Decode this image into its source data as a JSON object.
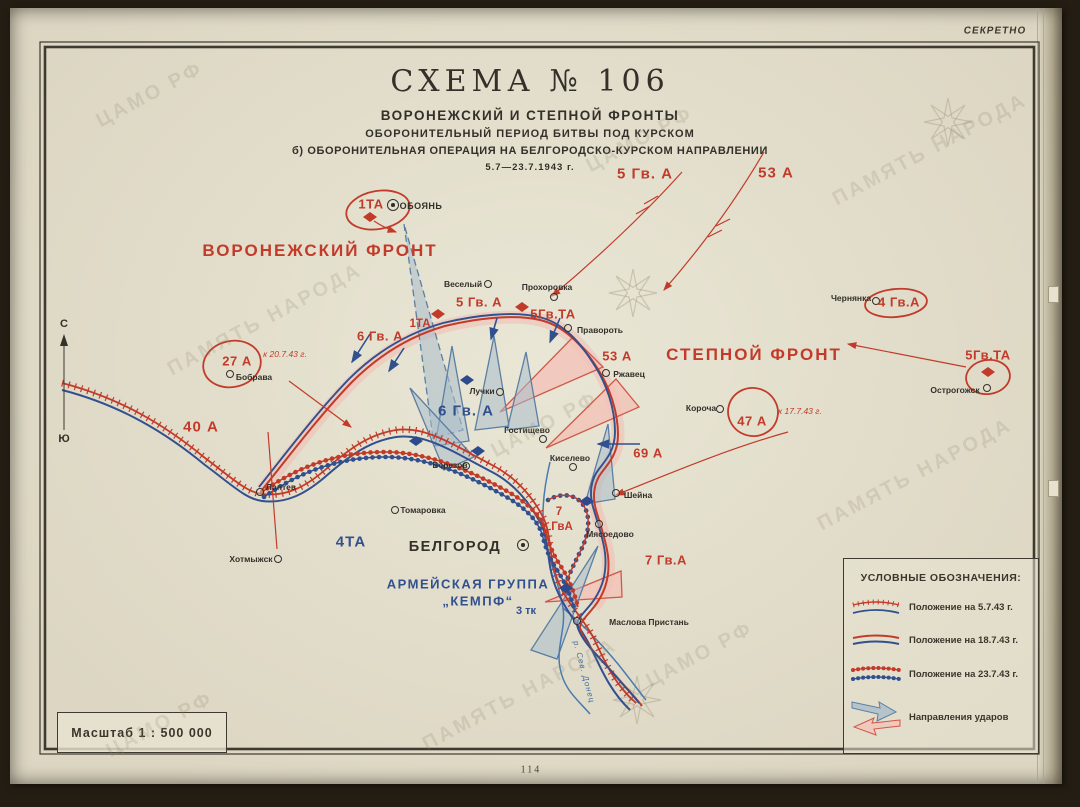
{
  "stamp": "СЕКРЕТНО",
  "title": {
    "main": "СХЕМА № 106",
    "sub1": "ВОРОНЕЖСКИЙ И СТЕПНОЙ ФРОНТЫ",
    "sub2": "ОБОРОНИТЕЛЬНЫЙ ПЕРИОД БИТВЫ ПОД КУРСКОМ",
    "sub3": "б) ОБОРОНИТЕЛЬНАЯ ОПЕРАЦИЯ НА БЕЛГОРОДСКО-КУРСКОМ НАПРАВЛЕНИИ",
    "dates": "5.7—23.7.1943 г."
  },
  "compass": {
    "north": "С",
    "south": "Ю"
  },
  "scale_label": "Масштаб 1 : 500 000",
  "page_number": "114",
  "legend": {
    "title": "УСЛОВНЫЕ ОБОЗНАЧЕНИЯ:",
    "items": [
      {
        "symbol": "position-5-7-43",
        "label": "Положение на  5.7.43 г."
      },
      {
        "symbol": "position-18-7-43",
        "label": "Положение на 18.7.43 г."
      },
      {
        "symbol": "position-23-7-43",
        "label": "Положение на 23.7.43 г."
      },
      {
        "symbol": "attack-directions",
        "label": "Направления ударов"
      }
    ]
  },
  "map_labels": [
    {
      "text": "ВОРОНЕЖСКИЙ ФРОНТ",
      "x": 320,
      "y": 251,
      "cls": "front"
    },
    {
      "text": "СТЕПНОЙ ФРОНТ",
      "x": 754,
      "y": 355,
      "cls": "front"
    },
    {
      "text": "5 Гв. А",
      "x": 645,
      "y": 174,
      "cls": "army-red-lg"
    },
    {
      "text": "53 А",
      "x": 776,
      "y": 173,
      "cls": "army-red-lg"
    },
    {
      "text": "1ТА",
      "x": 371,
      "y": 204,
      "cls": "army-red"
    },
    {
      "text": "5 Гв. А",
      "x": 479,
      "y": 302,
      "cls": "army-red"
    },
    {
      "text": "5Гв.ТА",
      "x": 553,
      "y": 314,
      "cls": "army-red"
    },
    {
      "text": "6 Гв. А",
      "x": 380,
      "y": 336,
      "cls": "army-red"
    },
    {
      "text": "1ТА",
      "x": 420,
      "y": 324,
      "cls": "army-red-sm"
    },
    {
      "text": "53 А",
      "x": 617,
      "y": 356,
      "cls": "army-red"
    },
    {
      "text": "69 А",
      "x": 648,
      "y": 453,
      "cls": "army-red"
    },
    {
      "text": "40 А",
      "x": 201,
      "y": 427,
      "cls": "army-red-lg"
    },
    {
      "text": "27 А",
      "x": 237,
      "y": 361,
      "cls": "army-red"
    },
    {
      "text": "к 20.7.43 г.",
      "x": 285,
      "y": 354,
      "cls": "note"
    },
    {
      "text": "47 А",
      "x": 752,
      "y": 421,
      "cls": "army-red"
    },
    {
      "text": "к 17.7.43 г.",
      "x": 800,
      "y": 411,
      "cls": "note"
    },
    {
      "text": "4 Гв.А",
      "x": 899,
      "y": 302,
      "cls": "army-red"
    },
    {
      "text": "5Гв.ТА",
      "x": 988,
      "y": 355,
      "cls": "army-red"
    },
    {
      "text": "7 Гв.А",
      "x": 666,
      "y": 560,
      "cls": "army-red"
    },
    {
      "text": "7",
      "x": 559,
      "y": 512,
      "cls": "army-red-sm"
    },
    {
      "text": "ГвА",
      "x": 562,
      "y": 527,
      "cls": "army-red-sm"
    },
    {
      "text": "4ТА",
      "x": 351,
      "y": 542,
      "cls": "army-blue"
    },
    {
      "text": "6 Гв. А",
      "x": 466,
      "y": 411,
      "cls": "army-blue"
    },
    {
      "text": "АРМЕЙСКАЯ ГРУППА",
      "x": 468,
      "y": 584,
      "cls": "army-blue-md"
    },
    {
      "text": "„КЕМПФ“",
      "x": 478,
      "y": 601,
      "cls": "army-blue-md"
    },
    {
      "text": "3 тк",
      "x": 526,
      "y": 611,
      "cls": "army-blue-sm"
    },
    {
      "text": "р. Сев. Донец",
      "x": 584,
      "y": 672,
      "cls": "river",
      "rot": 75
    }
  ],
  "towns": [
    {
      "name": "ОБОЯНЬ",
      "x": 393,
      "y": 205,
      "lx": 421,
      "ly": 206,
      "cls": "caps",
      "double": true
    },
    {
      "name": "Веселый",
      "x": 488,
      "y": 284,
      "lx": 463,
      "ly": 284
    },
    {
      "name": "Прохоровка",
      "x": 554,
      "y": 297,
      "lx": 547,
      "ly": 287
    },
    {
      "name": "Правороть",
      "x": 568,
      "y": 328,
      "lx": 600,
      "ly": 330
    },
    {
      "name": "Ржавец",
      "x": 606,
      "y": 373,
      "lx": 629,
      "ly": 374
    },
    {
      "name": "Лучки",
      "x": 500,
      "y": 392,
      "lx": 482,
      "ly": 391
    },
    {
      "name": "Гостищево",
      "x": 543,
      "y": 439,
      "lx": 527,
      "ly": 430
    },
    {
      "name": "Киселево",
      "x": 573,
      "y": 467,
      "lx": 570,
      "ly": 458
    },
    {
      "name": "Березов",
      "x": 466,
      "y": 466,
      "lx": 450,
      "ly": 465
    },
    {
      "name": "Лаптев",
      "x": 260,
      "y": 492,
      "lx": 281,
      "ly": 487
    },
    {
      "name": "Томаровка",
      "x": 395,
      "y": 510,
      "lx": 423,
      "ly": 510
    },
    {
      "name": "Хотмыжск",
      "x": 278,
      "y": 559,
      "lx": 251,
      "ly": 559
    },
    {
      "name": "Бобрава",
      "x": 230,
      "y": 374,
      "lx": 254,
      "ly": 377
    },
    {
      "name": "Короча",
      "x": 720,
      "y": 409,
      "lx": 701,
      "ly": 408
    },
    {
      "name": "Чернянка",
      "x": 876,
      "y": 301,
      "lx": 851,
      "ly": 298
    },
    {
      "name": "Острогожск",
      "x": 987,
      "y": 388,
      "lx": 955,
      "ly": 390
    },
    {
      "name": "БЕЛГОРОД",
      "x": 523,
      "y": 545,
      "lx": 455,
      "ly": 547,
      "cls": "city",
      "double": true
    },
    {
      "name": "Мясоедово",
      "x": 599,
      "y": 524,
      "lx": 610,
      "ly": 534
    },
    {
      "name": "Шейна",
      "x": 616,
      "y": 493,
      "lx": 638,
      "ly": 495
    },
    {
      "name": "Маслова Пристань",
      "x": 577,
      "y": 621,
      "lx": 649,
      "ly": 622
    }
  ],
  "unit_symbols": [
    {
      "type": "tank-unit-red",
      "x": 438,
      "y": 314
    },
    {
      "type": "tank-unit-red",
      "x": 522,
      "y": 307
    },
    {
      "type": "tank-unit-red",
      "x": 988,
      "y": 372
    },
    {
      "type": "tank-unit-red",
      "x": 370,
      "y": 217
    },
    {
      "type": "tank-unit-blue",
      "x": 467,
      "y": 380
    },
    {
      "type": "tank-unit-blue",
      "x": 416,
      "y": 441
    },
    {
      "type": "tank-unit-blue",
      "x": 478,
      "y": 451
    },
    {
      "type": "tank-unit-blue",
      "x": 587,
      "y": 501
    },
    {
      "type": "tank-unit-blue",
      "x": 566,
      "y": 588
    }
  ],
  "watermarks": [
    {
      "text": "ЦАМО РФ",
      "x": 150,
      "y": 95
    },
    {
      "text": "ПАМЯТЬ НАРОДА",
      "x": 265,
      "y": 320
    },
    {
      "text": "ЦАМО РФ",
      "x": 640,
      "y": 140
    },
    {
      "text": "ПАМЯТЬ НАРОДА",
      "x": 930,
      "y": 150
    },
    {
      "text": "ЦАМО РФ",
      "x": 545,
      "y": 425
    },
    {
      "text": "ПАМЯТЬ НАРОДА",
      "x": 915,
      "y": 475
    },
    {
      "text": "ЦАМО РФ",
      "x": 700,
      "y": 655
    },
    {
      "text": "ПАМЯТЬ НАРОДА",
      "x": 520,
      "y": 695
    },
    {
      "text": "ЦАМО РФ",
      "x": 160,
      "y": 725
    }
  ],
  "colors": {
    "paper": "#e8e4d2",
    "red": "#c23b2a",
    "blue": "#31508e",
    "gray_arrow": "#a9bdca",
    "pink": "#f2c2b8",
    "ink": "#33302a"
  }
}
